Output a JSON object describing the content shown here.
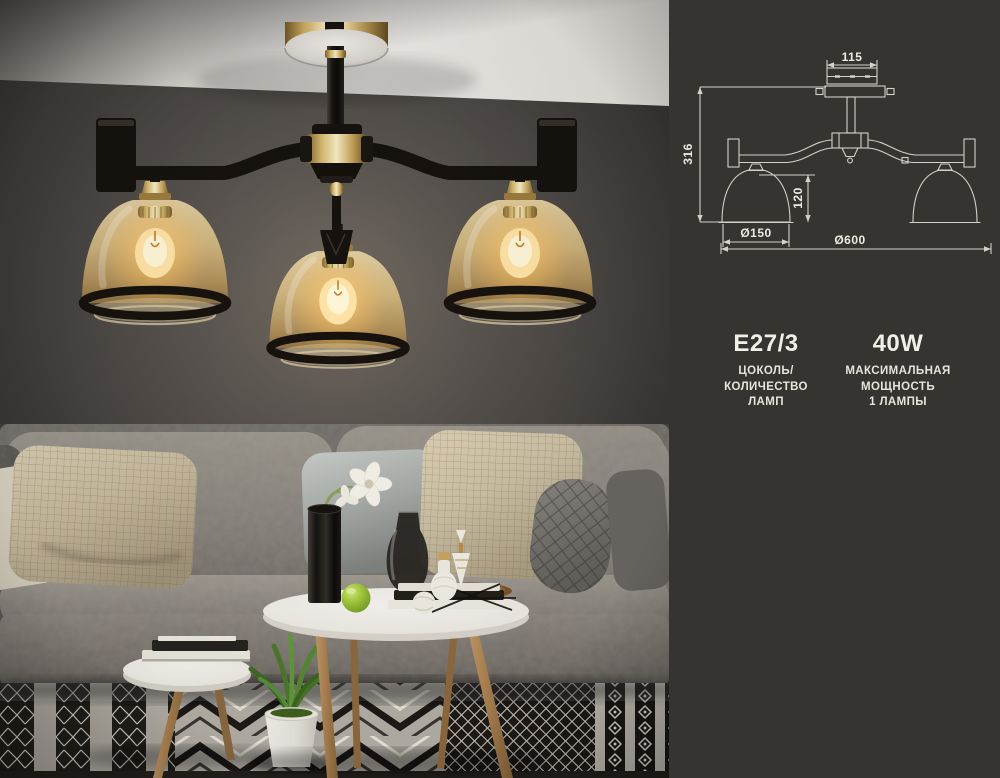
{
  "product_card": {
    "photo": {
      "subject": "ceiling-chandelier-room-photo"
    },
    "diagram": {
      "labels": {
        "canopy_width": "115",
        "total_height": "316",
        "shade_height": "120",
        "shade_diameter": "Ø150",
        "fixture_diameter": "Ø600"
      }
    },
    "specs": [
      {
        "value": "E27/3",
        "caption_line1": "ЦОКОЛЬ/",
        "caption_line2": "КОЛИЧЕСТВО",
        "caption_line3": "ЛАМП"
      },
      {
        "value": "40W",
        "caption_line1": "МАКСИМАЛЬНАЯ",
        "caption_line2": "МОЩНОСТЬ",
        "caption_line3": "1 ЛАМПЫ"
      }
    ],
    "colors": {
      "panel_background": "#363330",
      "diagram_line": "#d4d1ca",
      "text": "#f0ede5",
      "glass_amber": "#cfa763",
      "accent_gold": "#c9a55e",
      "wall": "#454240",
      "rug_dark": "#1d1a17"
    }
  }
}
